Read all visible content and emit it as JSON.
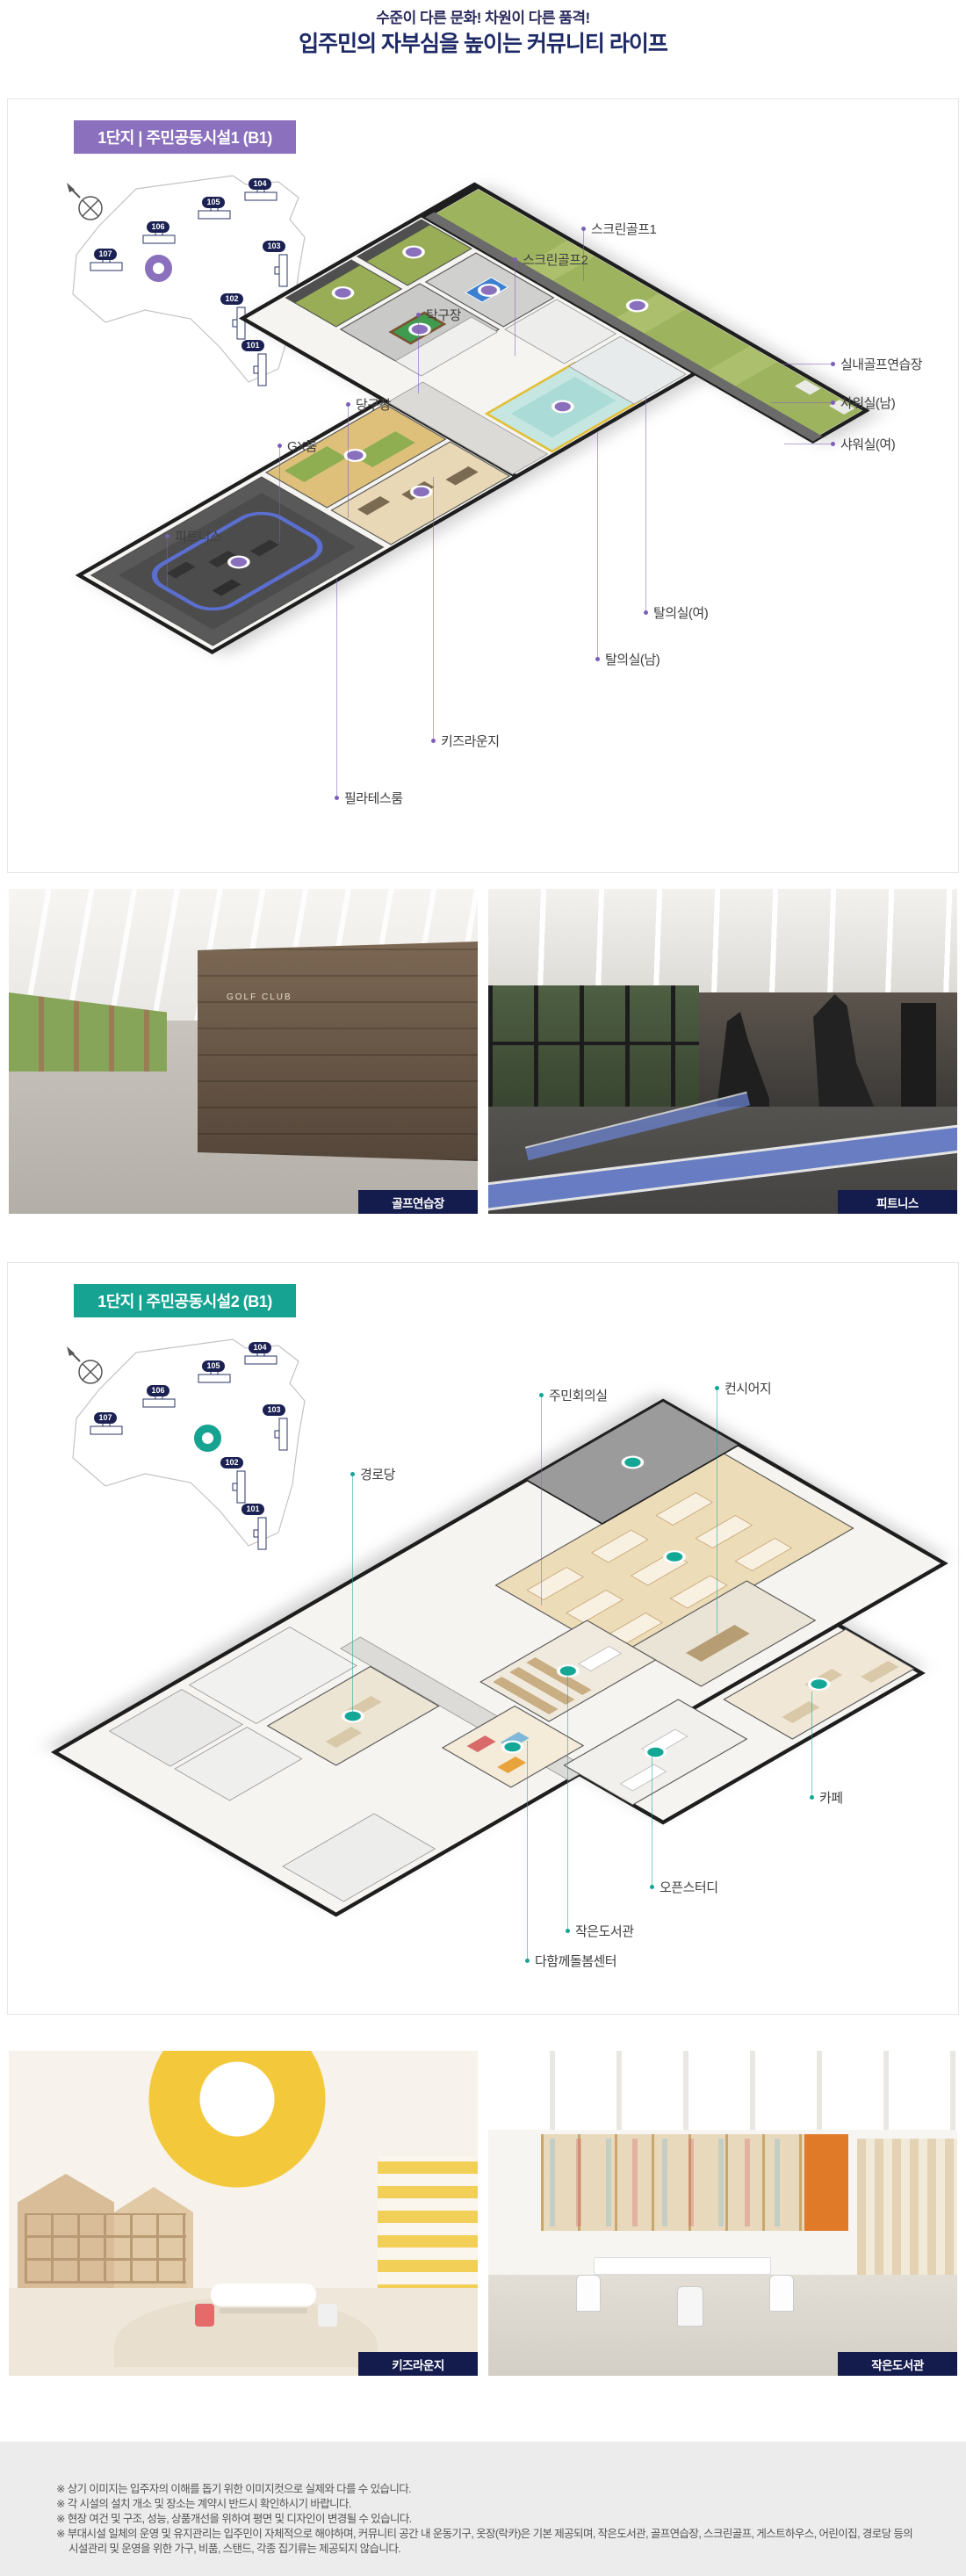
{
  "header": {
    "tagline": "수준이 다른 문화! 차원이 다른 품격!",
    "title": "입주민의 자부심을 높이는 커뮤니티 라이프"
  },
  "section1": {
    "badge": "1단지 | 주민공동시설1 (B1)",
    "theme_color": "#8a70bd",
    "sitemap": {
      "buildings": [
        "104",
        "105",
        "106",
        "107",
        "103",
        "102",
        "101"
      ]
    },
    "labels": [
      "스크린골프1",
      "스크린골프2",
      "탁구장",
      "당구장",
      "GX룸",
      "피트니스",
      "실내골프연습장",
      "샤워실(남)",
      "샤워실(여)",
      "탈의실(여)",
      "탈의실(남)",
      "키즈라운지",
      "필라테스룸"
    ]
  },
  "photos1": [
    {
      "caption": "골프연습장",
      "sign": "GOLF CLUB"
    },
    {
      "caption": "피트니스"
    }
  ],
  "section2": {
    "badge": "1단지 | 주민공동시설2 (B1)",
    "theme_color": "#16a392",
    "sitemap": {
      "buildings": [
        "104",
        "105",
        "106",
        "107",
        "103",
        "102",
        "101"
      ]
    },
    "labels": [
      "주민회의실",
      "컨시어지",
      "경로당",
      "카페",
      "오픈스터디",
      "작은도서관",
      "다함께돌봄센터"
    ]
  },
  "photos2": [
    {
      "caption": "키즈라운지"
    },
    {
      "caption": "작은도서관"
    }
  ],
  "footer": {
    "notes": [
      "※ 상기 이미지는 입주자의 이해를 돕기 위한 이미지컷으로 실제와 다를 수 있습니다.",
      "※ 각 시설의 설치 개소 및 장소는 계약시 반드시 확인하시기 바랍니다.",
      "※ 현장 여건 및 구조, 성능, 상품개선을 위하여 평면 및 디자인이 변경될 수 있습니다.",
      "※ 부대시설 일체의 운영 및 유지관리는 입주민이 자체적으로 해야하며, 커뮤니티 공간 내 운동기구, 옷장(락카)은 기본 제공되며, 작은도서관, 골프연습장, 스크린골프, 게스트하우스, 어린이집, 경로당 등의",
      "시설관리 및 운영을 위한 가구, 비품, 스탠드, 각종 집기류는 제공되지 않습니다."
    ]
  },
  "colors": {
    "title_navy": "#1e2a66",
    "badge1_purple": "#8a70bd",
    "badge2_teal": "#16a392",
    "building_badge_navy": "#1b2153",
    "caption_badge_navy": "#141b4d"
  }
}
